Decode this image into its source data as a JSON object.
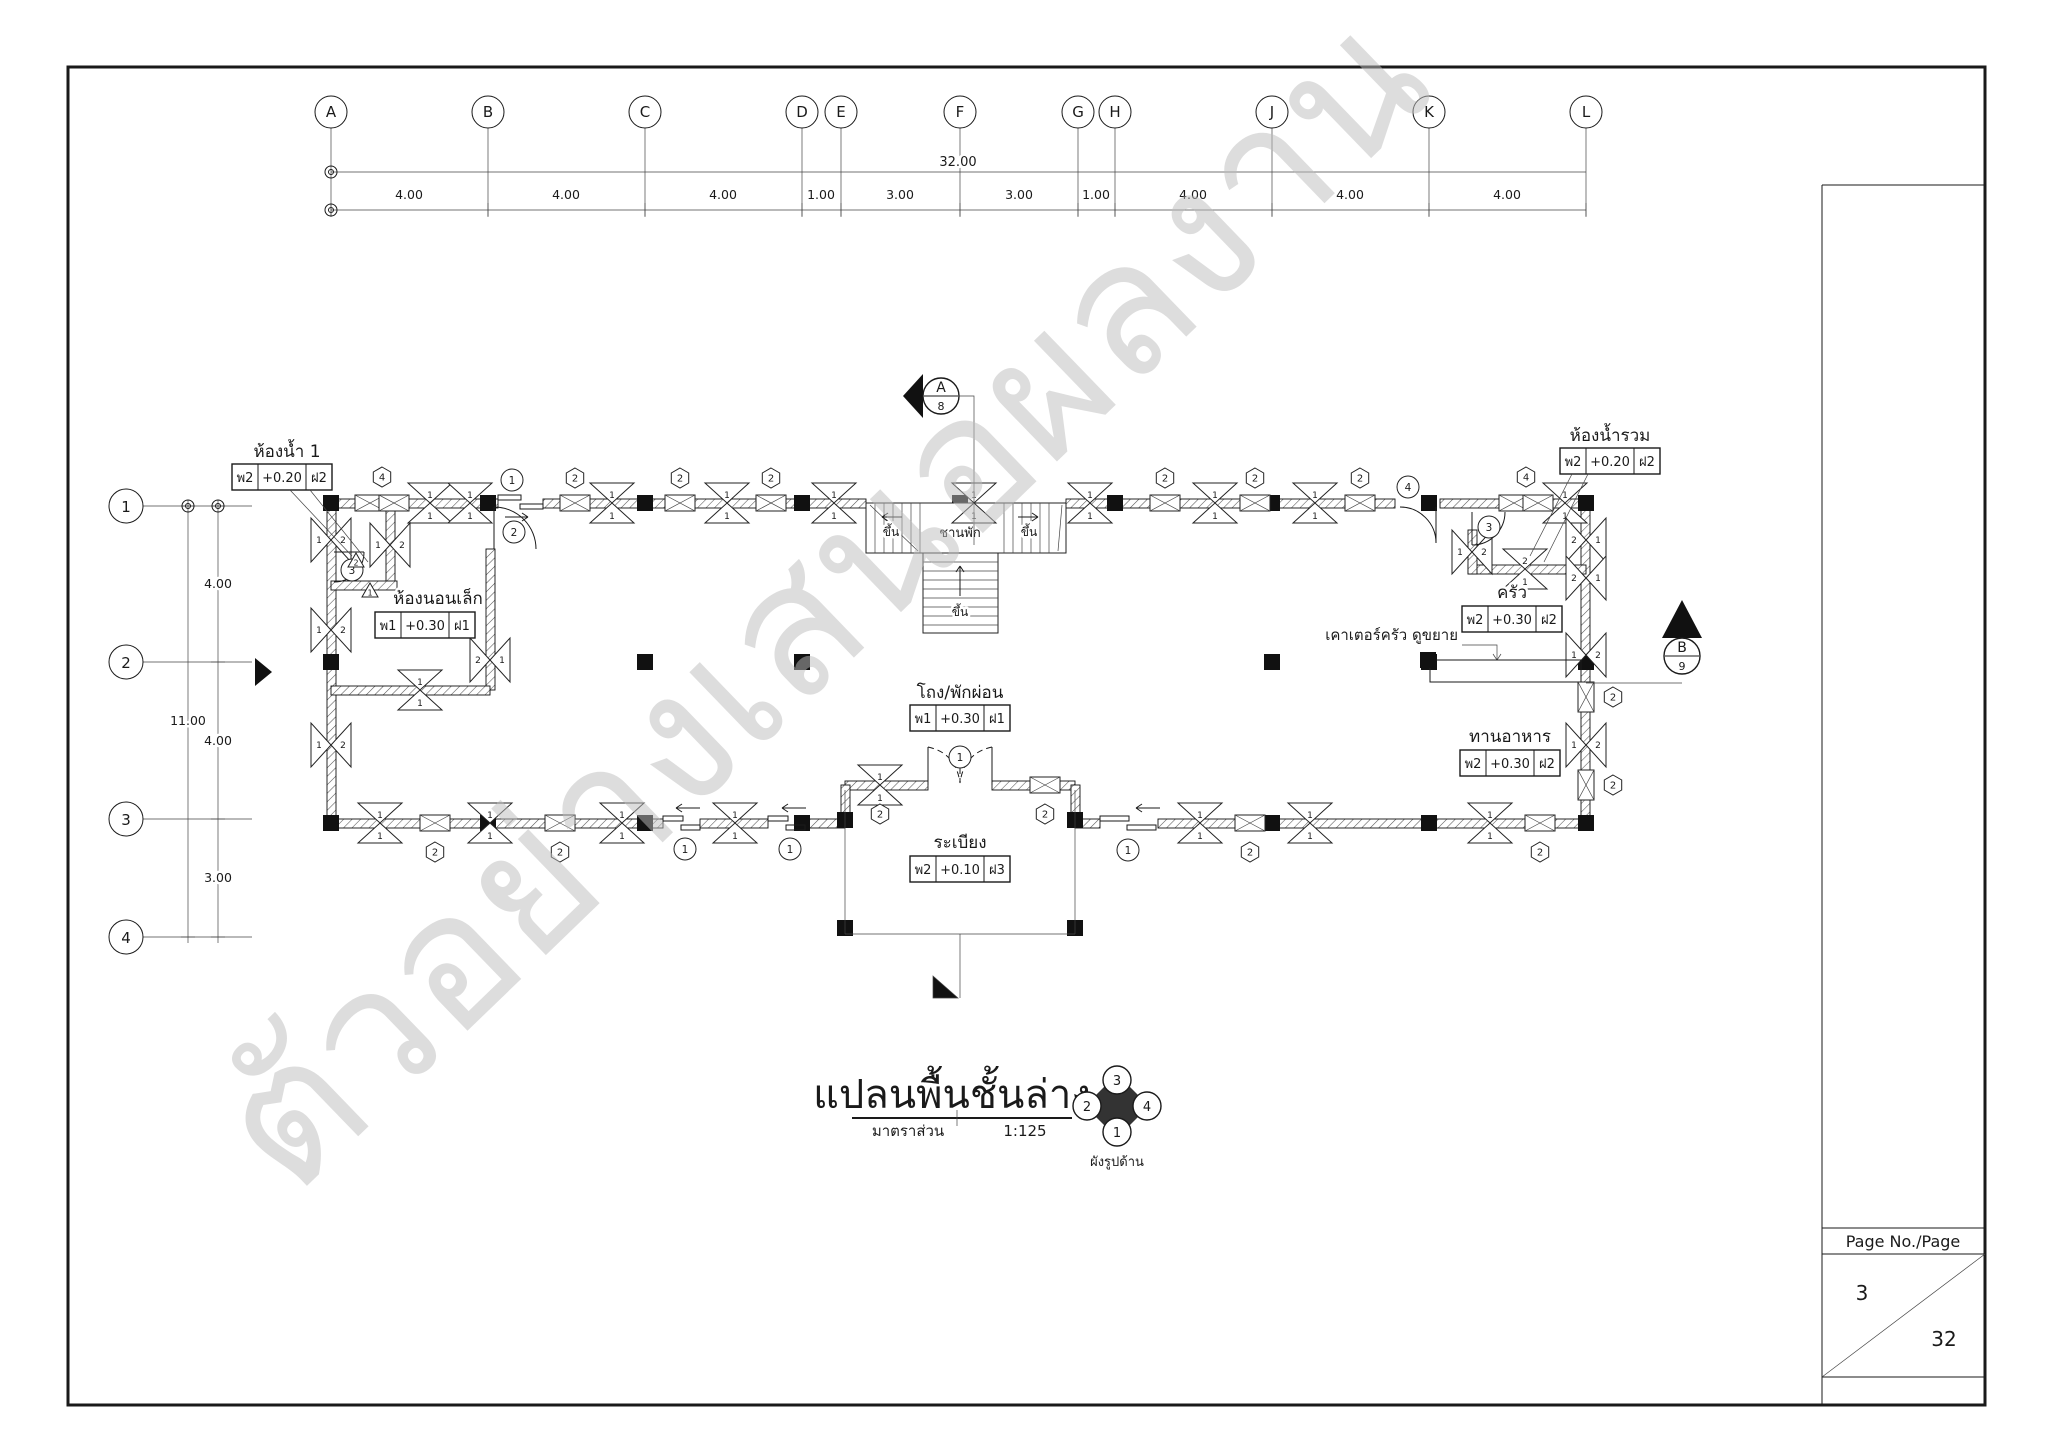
{
  "page": {
    "background": "#ffffff",
    "line_color": "#1a1a1a"
  },
  "watermark": {
    "text": "ตัวอย่างเสนอผลงาน",
    "color": "#bdbdbd"
  },
  "grid": {
    "columns": [
      "A",
      "B",
      "C",
      "D",
      "E",
      "F",
      "G",
      "H",
      "J",
      "K",
      "L"
    ],
    "column_dims": [
      "4.00",
      "4.00",
      "4.00",
      "1.00",
      "3.00",
      "3.00",
      "1.00",
      "4.00",
      "4.00",
      "4.00"
    ],
    "total_width": "32.00",
    "rows": [
      "1",
      "2",
      "3",
      "4"
    ],
    "row_dims": [
      "4.00",
      "4.00",
      "3.00"
    ],
    "total_height": "11.00"
  },
  "rooms": [
    {
      "name": "ห้องน้ำ 1",
      "wall_type": "พ2",
      "floor_level": "+0.20",
      "ceiling_type": "ฝ2"
    },
    {
      "name": "ห้องนอนเล็ก",
      "wall_type": "พ1",
      "floor_level": "+0.30",
      "ceiling_type": "ฝ1"
    },
    {
      "name": "โถง/พักผ่อน",
      "wall_type": "พ1",
      "floor_level": "+0.30",
      "ceiling_type": "ฝ1"
    },
    {
      "name": "ระเบียง",
      "wall_type": "พ2",
      "floor_level": "+0.10",
      "ceiling_type": "ฝ3"
    },
    {
      "name": "ครัว",
      "wall_type": "พ2",
      "floor_level": "+0.30",
      "ceiling_type": "ฝ2"
    },
    {
      "name": "ทานอาหาร",
      "wall_type": "พ2",
      "floor_level": "+0.30",
      "ceiling_type": "ฝ2"
    },
    {
      "name": "ห้องน้ำรวม",
      "wall_type": "พ2",
      "floor_level": "+0.20",
      "ceiling_type": "ฝ2"
    }
  ],
  "stair": {
    "landing": "ชานพัก",
    "up": "ขึ้น"
  },
  "annotations": {
    "kitchen_counter": "เคาเตอร์ครัว ดูขยาย"
  },
  "sections": [
    {
      "letter": "A",
      "sheet": "8"
    },
    {
      "letter": "B",
      "sheet": "9"
    }
  ],
  "title": {
    "text": "แปลนพื้นชั้นล่าง",
    "scale_label": "มาตราส่วน",
    "scale_value": "1:125"
  },
  "compass": {
    "label": "ผังรูปด้าน",
    "top": "3",
    "left": "2",
    "right": "4",
    "bottom": "1"
  },
  "title_block": {
    "header": "Page No./Page",
    "page_no": "3",
    "total_pages": "32"
  },
  "symbols": {
    "t1": "1",
    "t2": "2",
    "t3": "3",
    "t4": "4"
  }
}
